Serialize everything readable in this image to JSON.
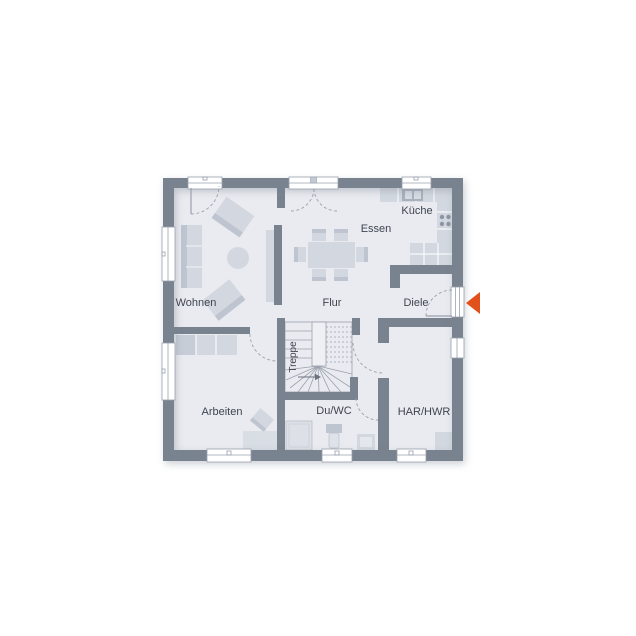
{
  "plan": {
    "rooms": {
      "wohnen": "Wohnen",
      "essen": "Essen",
      "kueche": "Küche",
      "diele": "Diele",
      "flur": "Flur",
      "treppe": "Treppe",
      "arbeiten": "Arbeiten",
      "du_wc": "Du/WC",
      "har_hwr": "HAR/HWR"
    },
    "colors": {
      "wall": "#79828F",
      "floor": "#E9EBF0",
      "furniture": "#D3D8E0",
      "furniture_dark": "#BEC5D0",
      "kitchen_fixture": "#A9B1BD",
      "line": "#9AA1AD",
      "label": "#3F4550",
      "accent": "#E2511B",
      "background": "#FFFFFF"
    }
  }
}
